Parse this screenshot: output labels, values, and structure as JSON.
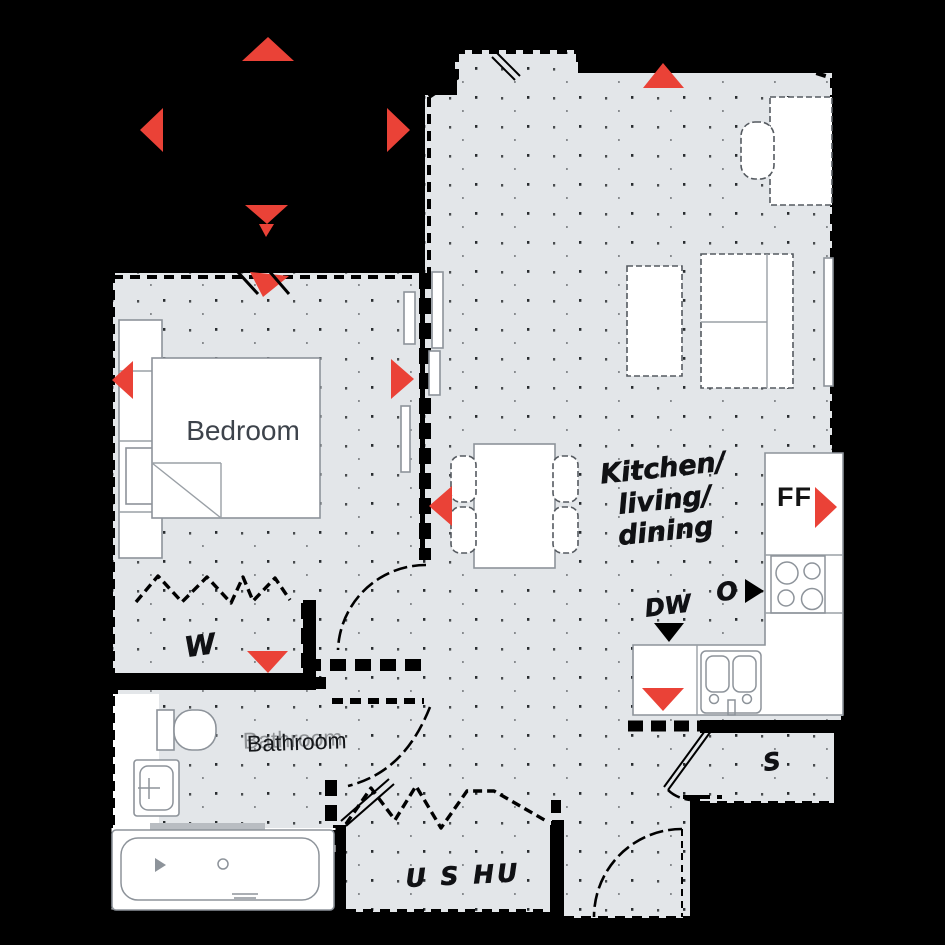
{
  "title": "Apartment floor plan",
  "colors": {
    "background": "#000000",
    "floor": "#e3e6e9",
    "wall": "#000000",
    "accent_red": "#ea4237",
    "furniture": "#ffffff",
    "text": "#16181b"
  },
  "rooms": {
    "bedroom": {
      "label": "Bedroom"
    },
    "bathroom": {
      "label": "Bathroom"
    },
    "kitchen": {
      "line1": "Kitchen/",
      "line2": "living/",
      "line3": "dining"
    },
    "wardrobe": {
      "label": "W"
    },
    "storage": {
      "label": "S"
    },
    "utility": {
      "label": "U S HU"
    }
  },
  "appliances": {
    "fridge_freezer": "FF",
    "oven": "O",
    "dishwasher": "DW"
  }
}
